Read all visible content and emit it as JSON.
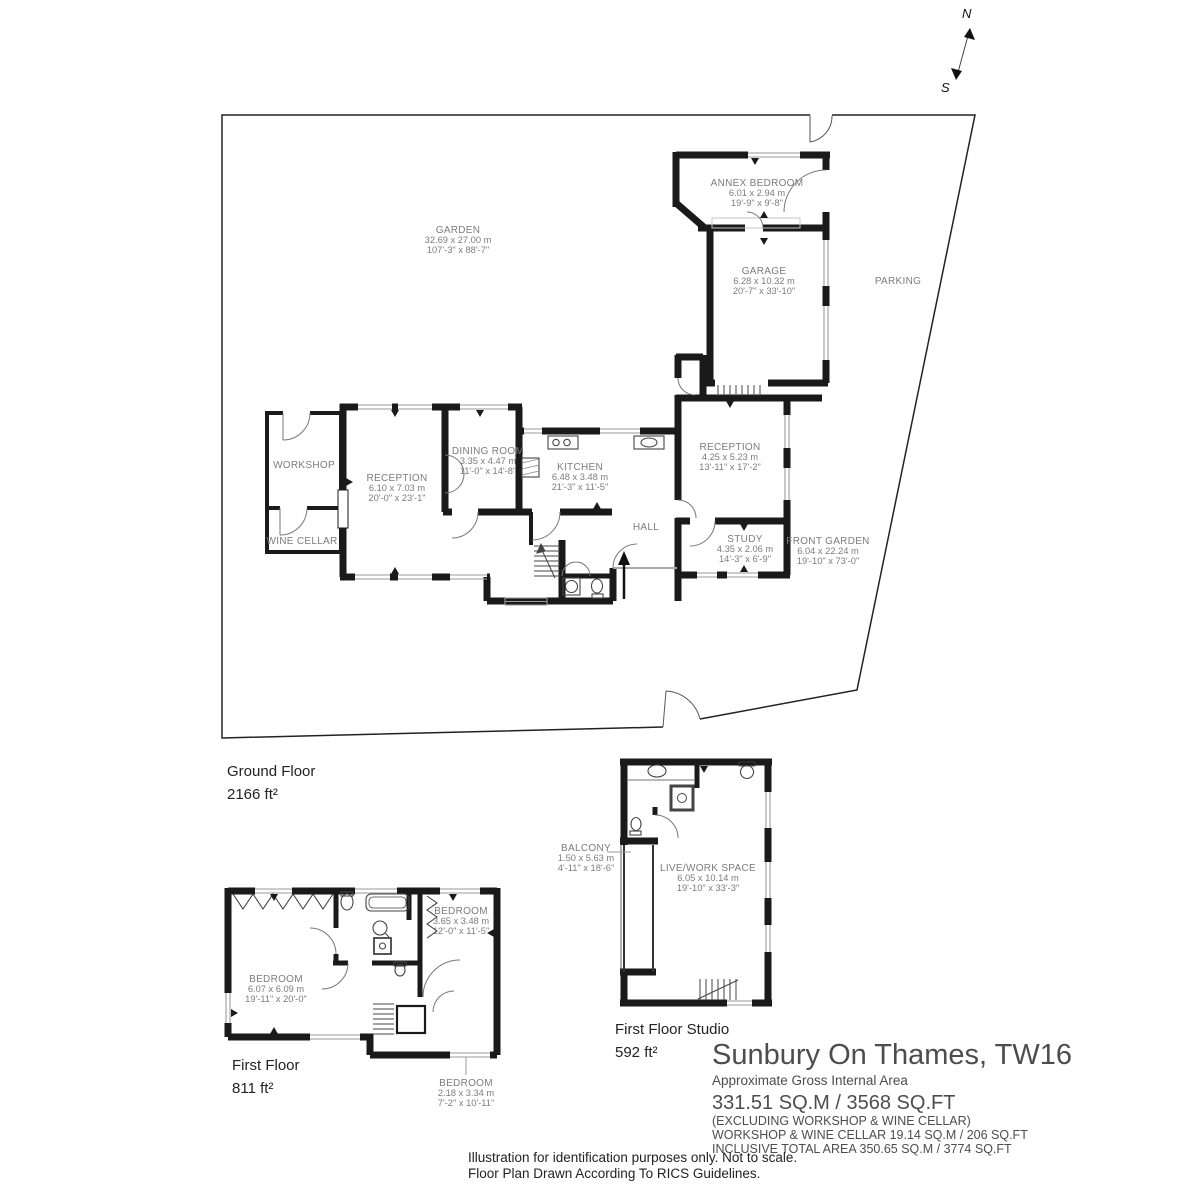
{
  "compass": {
    "north": "N",
    "south": "S"
  },
  "rooms": {
    "garden": {
      "name": "GARDEN",
      "metric": "32.69 x 27.00 m",
      "imperial": "107'-3\" x 88'-7\""
    },
    "parking": {
      "name": "PARKING"
    },
    "annex_bedroom": {
      "name": "ANNEX BEDROOM",
      "metric": "6.01 x 2.94 m",
      "imperial": "19'-9\" x 9'-8\""
    },
    "garage": {
      "name": "GARAGE",
      "metric": "6.28 x 10.32 m",
      "imperial": "20'-7\" x 33'-10\""
    },
    "workshop": {
      "name": "WORKSHOP"
    },
    "wine_cellar": {
      "name": "WINE CELLAR"
    },
    "reception_main": {
      "name": "RECEPTION",
      "metric": "6.10 x 7.03 m",
      "imperial": "20'-0\" x 23'-1\""
    },
    "dining_room": {
      "name": "DINING ROOM",
      "metric": "3.35 x 4.47 m",
      "imperial": "11'-0\" x 14'-8\""
    },
    "kitchen": {
      "name": "KITCHEN",
      "metric": "6.48 x 3.48 m",
      "imperial": "21'-3\" x 11'-5\""
    },
    "reception_right": {
      "name": "RECEPTION",
      "metric": "4.25 x 5.23 m",
      "imperial": "13'-11\" x 17'-2\""
    },
    "hall": {
      "name": "HALL"
    },
    "study": {
      "name": "STUDY",
      "metric": "4.35 x 2.06 m",
      "imperial": "14'-3\" x 6'-9\""
    },
    "front_garden": {
      "name": "FRONT GARDEN",
      "metric": "6.04 x 22.24 m",
      "imperial": "19'-10\" x 73'-0\""
    },
    "bedroom_main": {
      "name": "BEDROOM",
      "metric": "6.07 x 6.09 m",
      "imperial": "19'-11\" x 20'-0\""
    },
    "bedroom_2": {
      "name": "BEDROOM",
      "metric": "3.65 x 3.48 m",
      "imperial": "12'-0\" x 11'-5\""
    },
    "bedroom_3": {
      "name": "BEDROOM",
      "metric": "2.18 x 3.34 m",
      "imperial": "7'-2\" x 10'-11\""
    },
    "balcony": {
      "name": "BALCONY",
      "metric": "1.50 x 5.63 m",
      "imperial": "4'-11\" x 18'-6\""
    },
    "live_work": {
      "name": "LIVE/WORK SPACE",
      "metric": "6.05 x 10.14 m",
      "imperial": "19'-10\" x 33'-3\""
    }
  },
  "captions": {
    "ground": {
      "title": "Ground Floor",
      "area": "2166 ft²"
    },
    "first": {
      "title": "First Floor",
      "area": "811 ft²"
    },
    "studio": {
      "title": "First Floor Studio",
      "area": "592 ft²"
    }
  },
  "title_block": {
    "title": "Sunbury On Thames, TW16",
    "subtitle": "Approximate Gross Internal Area",
    "area_main": "331.51 SQ.M / 3568 SQ.FT",
    "note1": "(EXCLUDING WORKSHOP & WINE CELLAR)",
    "note2": "WORKSHOP & WINE CELLAR 19.14 SQ.M / 206 SQ.FT",
    "note3": "INCLUSIVE TOTAL AREA 350.65 SQ.M / 3774 SQ.FT"
  },
  "disclaimer": {
    "line1": "Illustration for identification purposes only. Not to scale.",
    "line2": "Floor Plan Drawn According To RICS Guidelines."
  },
  "colors": {
    "wall": "#1a1a1a",
    "window": "#9a9a9a",
    "label": "#7c7c7c"
  }
}
